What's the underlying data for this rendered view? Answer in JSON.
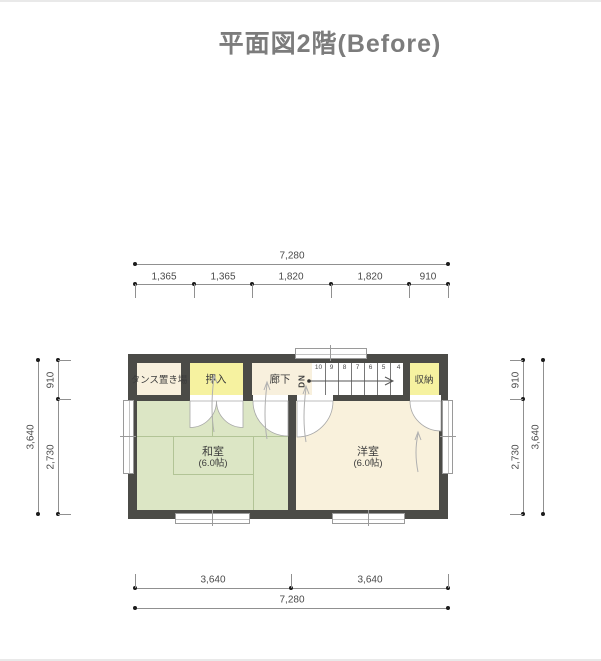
{
  "title": "平面図2階(Before)",
  "plan": {
    "rooms": {
      "tansu": "タンス置き場",
      "oshiire": "押入",
      "rouka": "廊下",
      "shuunou": "収納",
      "washitsu": "和室",
      "washitsu_size": "(6.0帖)",
      "youshitsu": "洋室",
      "youshitsu_size": "(6.0帖)"
    },
    "stairs": {
      "label": "DN",
      "steps": [
        "10",
        "9",
        "8",
        "7",
        "6",
        "5",
        "4"
      ]
    }
  },
  "dimensions": {
    "top": {
      "total": "7,280",
      "segments": [
        "1,365",
        "1,365",
        "1,820",
        "1,820",
        "910"
      ]
    },
    "bottom": {
      "total": "7,280",
      "segments": [
        "3,640",
        "3,640"
      ]
    },
    "left": {
      "total": "3,640",
      "segments": [
        "910",
        "2,730"
      ]
    },
    "right": {
      "total": "3,640",
      "segments": [
        "910",
        "2,730"
      ]
    }
  },
  "colors": {
    "wall": "#4b4b47",
    "tatami_floor": "#dce6c5",
    "tatami_line": "#b2c496",
    "wood_floor": "#f9f1dc",
    "closet_yellow": "#f6f2a0",
    "title_text": "#7c7c7c",
    "dimension_text": "#4a4a4a"
  }
}
